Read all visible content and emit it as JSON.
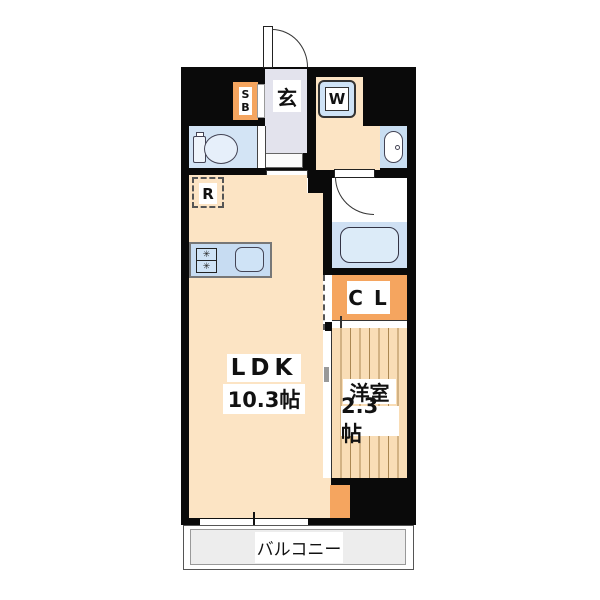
{
  "plan_title": "apartment-floor-plan",
  "rooms": {
    "ldk": {
      "name": "LDK",
      "size": "10.3帖"
    },
    "western": {
      "name": "洋室",
      "size": "2.3帖"
    },
    "balcony": {
      "name": "バルコニー"
    },
    "entrance": {
      "name": "玄"
    },
    "closet": {
      "name": "C L"
    },
    "shoebox": {
      "line1": "S",
      "line2": "B"
    },
    "washer": {
      "name": "W"
    },
    "refrigerator": {
      "name": "R"
    }
  },
  "kitchen": {
    "burner_icon": "✳"
  },
  "colors": {
    "wall": "#0a0a0a",
    "floor_cream": "#fce4c4",
    "wood_floor": "#f9ddb6",
    "wood_line": "#aa8753",
    "water_blue": "#cfe3f6",
    "genkan_gray": "#e3e3ed",
    "accent_orange": "#f5a55f",
    "balcony_gray": "#ededed"
  }
}
